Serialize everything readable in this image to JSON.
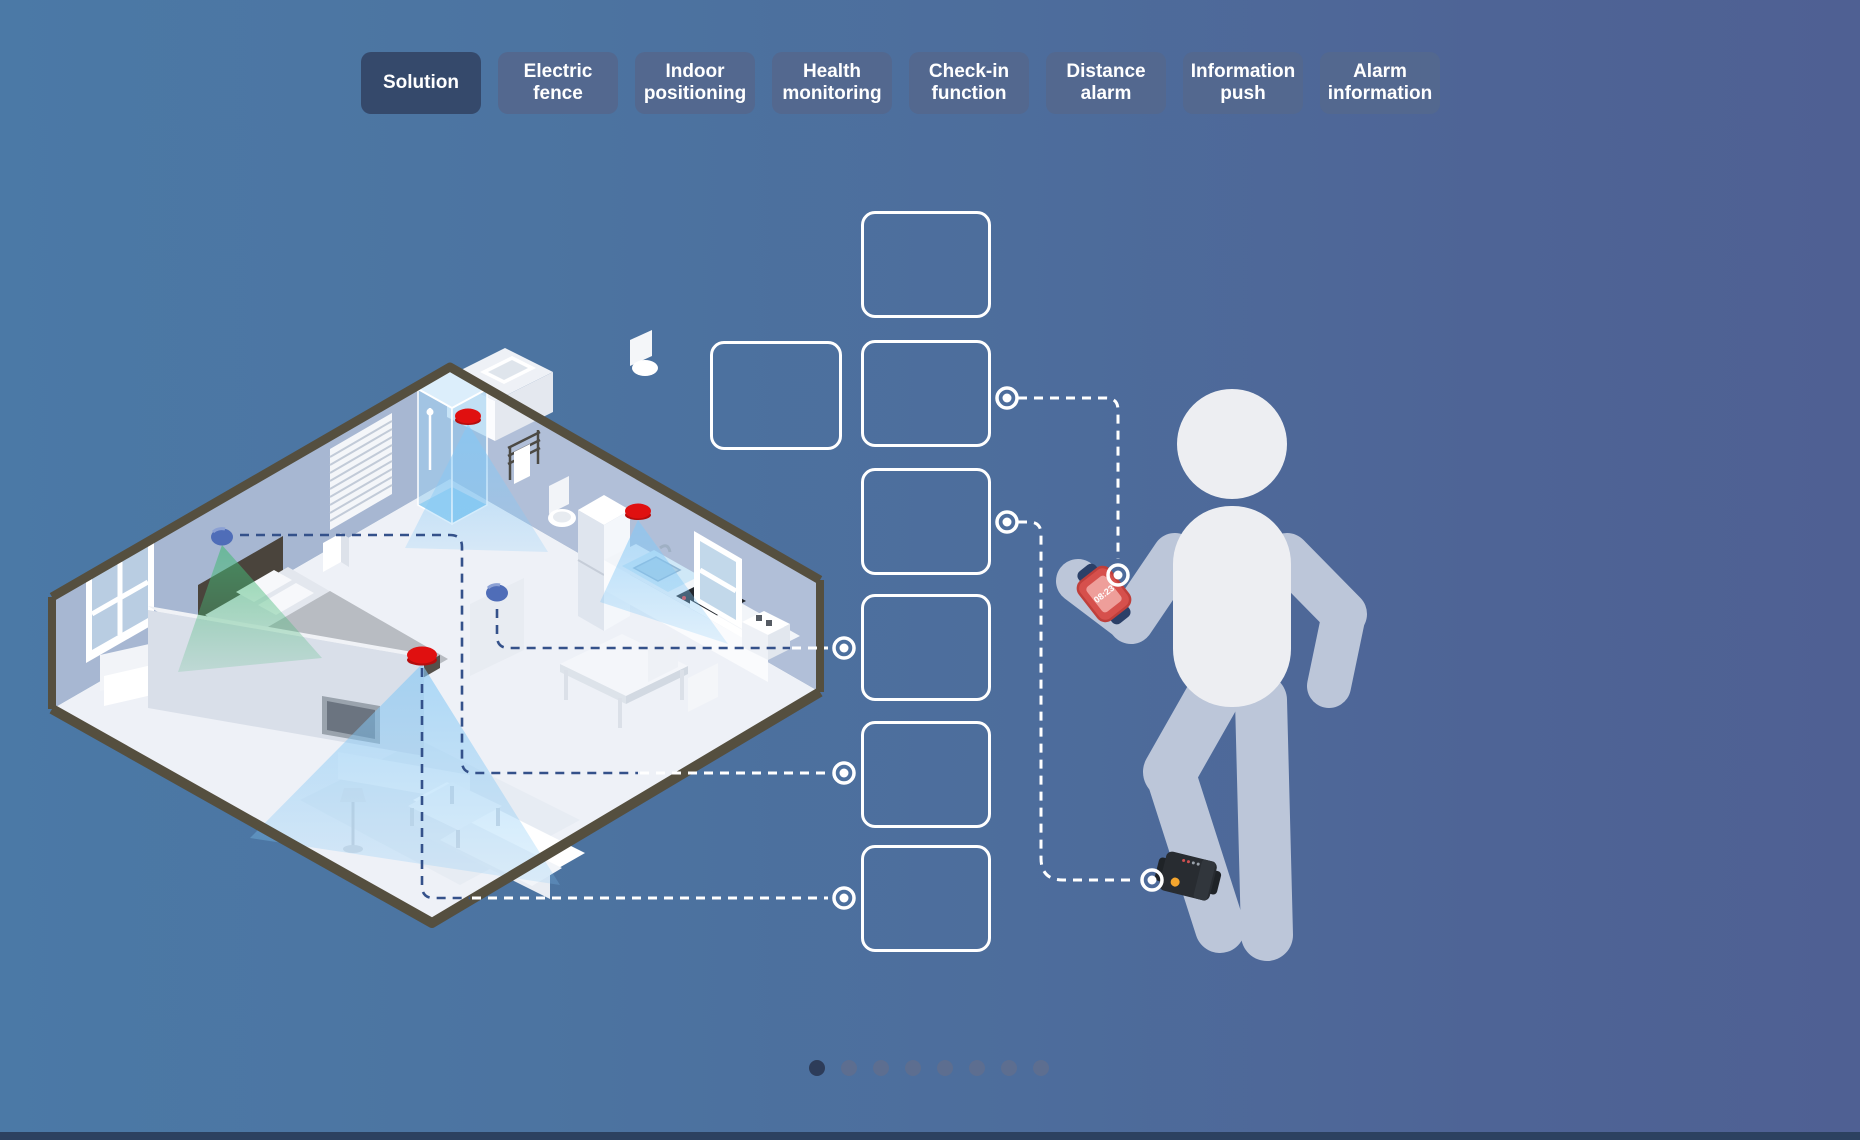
{
  "page": {
    "background_gradient": [
      "#4b79a6",
      "#4f6093"
    ],
    "footer_bar_color": "#2c4160"
  },
  "tab_bar": {
    "tabs": [
      {
        "label": "Solution",
        "active": true
      },
      {
        "label": "Electric fence",
        "active": false
      },
      {
        "label": "Indoor positioning",
        "active": false
      },
      {
        "label": "Health monitoring",
        "active": false
      },
      {
        "label": "Check-in function",
        "active": false
      },
      {
        "label": "Distance alarm",
        "active": false
      },
      {
        "label": "Information push",
        "active": false
      },
      {
        "label": "Alarm information",
        "active": false
      }
    ]
  },
  "carousel": {
    "placeholder_card_count": 7,
    "pagination": {
      "total_dots": 8,
      "active_index": 0
    }
  },
  "person": {
    "watch_time": "08:23"
  },
  "colors": {
    "active_tab": "#35496b",
    "inactive_tab": "#53688f",
    "sensor_red": "#e01010",
    "dome_sensor_blue": "#4f6db8",
    "cone_blue": "#84c8f6",
    "cone_green": "#46b978",
    "connector_white": "#ffffff",
    "connector_navy": "#34518a",
    "watch_red": "#d6504c",
    "watch_strap_navy": "#2b4068",
    "ankle_band_black": "#26292e",
    "ankle_led_orange": "#f5a62e",
    "pagination_active": "#2d3c59",
    "pagination_inactive": "#5d6e90",
    "wall_trim": "#554f3f"
  }
}
